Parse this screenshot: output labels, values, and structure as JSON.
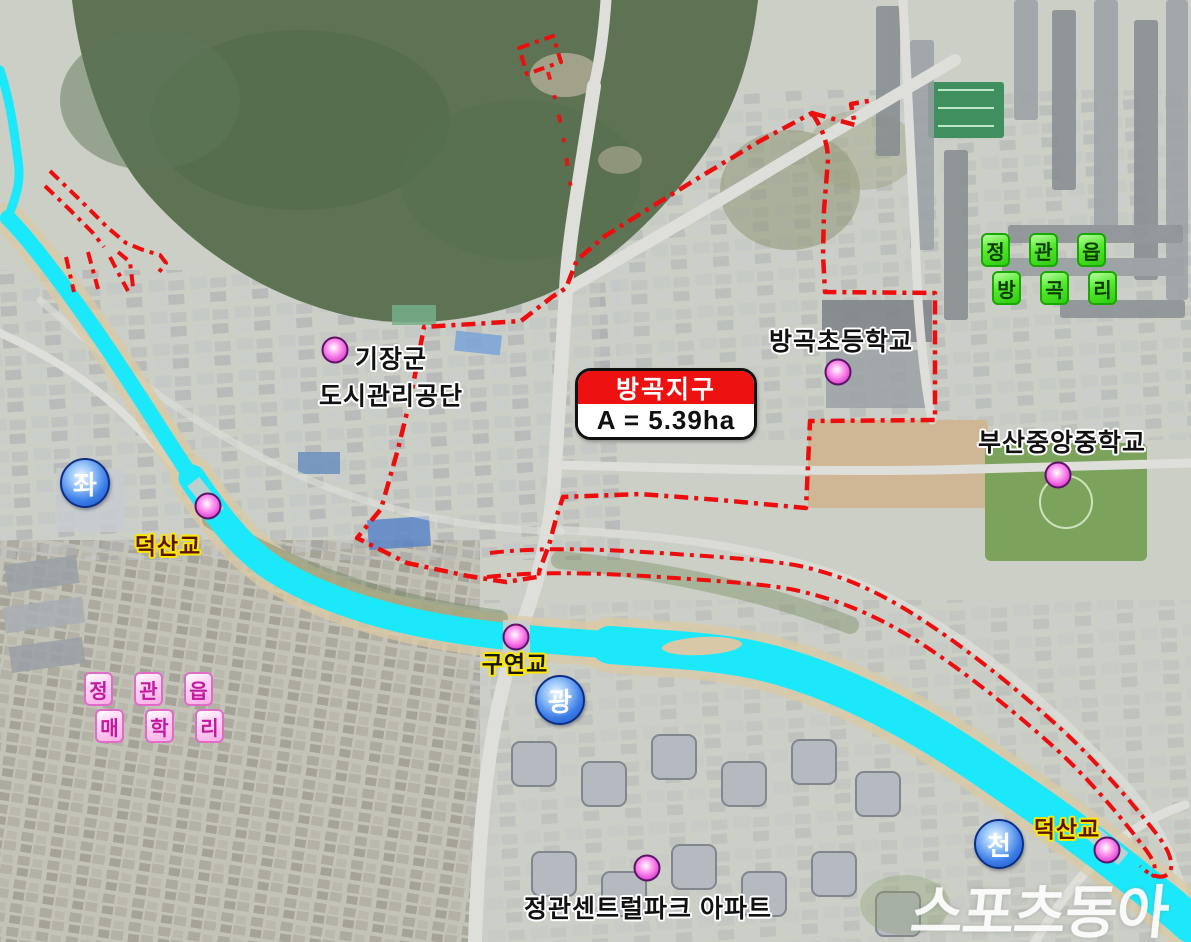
{
  "district": {
    "name": "방곡지구",
    "area": "A = 5.39ha"
  },
  "regions": {
    "banggok": {
      "row1": [
        "정",
        "관",
        "읍"
      ],
      "row2": [
        "방",
        "곡",
        "리"
      ]
    },
    "maehak": {
      "row1": [
        "정",
        "관",
        "읍"
      ],
      "row2": [
        "매",
        "학",
        "리"
      ]
    }
  },
  "places": {
    "gijang_line1": "기장군",
    "gijang_line2": "도시관리공단",
    "banggok_elementary": "방곡초등학교",
    "busan_jungang_middle": "부산중앙중학교",
    "centralpark_apt": "정관센트럴파크 아파트"
  },
  "bridges": {
    "deoksan_nw": "덕산교",
    "guyeon": "구연교",
    "deoksan_se": "덕산교"
  },
  "stream_badges": {
    "badge1": "좌",
    "badge2": "광",
    "badge3": "천"
  },
  "watermark": "스포츠동아",
  "colors": {
    "boundary_red": "#ed0d0d",
    "river_cyan": "#1be9fb",
    "title_red": "#ee1111",
    "badge_blue": "#3c7de8",
    "marker_magenta": "#e44fd8",
    "green_label": "#55e82e",
    "pink_label": "#f8aee6",
    "outline_yellow": "#ffe800",
    "forest_green": "#5d7354"
  }
}
